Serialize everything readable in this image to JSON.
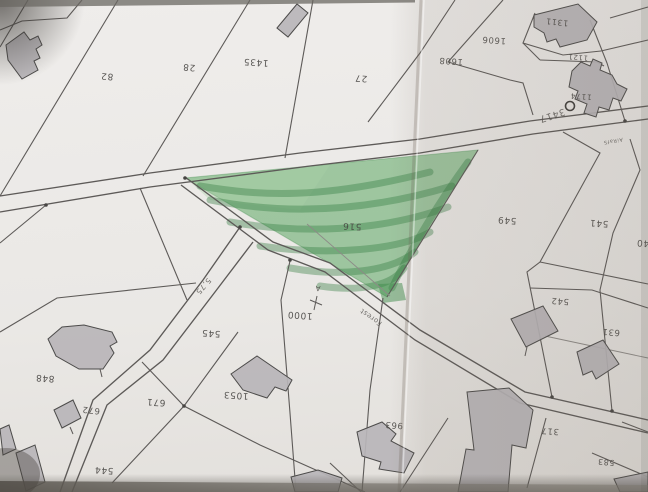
{
  "scene": {
    "description": "Photograph of a paper cadastral plan, shot upside-down; a triangular parcel is highlighted with green marker. A fold shadow runs down the right side and photo edges are dark.",
    "paper_color": "#eceae7",
    "ink_color": "#5d5a58",
    "building_color": "#b8b5b9",
    "highlight_color": "#57a45e",
    "highlighted_parcel": "516",
    "text_orientation": "all map labels appear rotated 180°"
  },
  "labels": {
    "parcels": [
      {
        "text": "82",
        "x": 107,
        "y": 76,
        "r": 184,
        "s": 9
      },
      {
        "text": "28",
        "x": 189,
        "y": 67,
        "r": 184,
        "s": 9
      },
      {
        "text": "1435",
        "x": 256,
        "y": 62,
        "r": 184,
        "s": 9
      },
      {
        "text": "27",
        "x": 361,
        "y": 78,
        "r": 184,
        "s": 9
      },
      {
        "text": "1311",
        "x": 557,
        "y": 22,
        "r": 186,
        "s": 8
      },
      {
        "text": "1608",
        "x": 451,
        "y": 61,
        "r": 184,
        "s": 8.5
      },
      {
        "text": "1606",
        "x": 494,
        "y": 40,
        "r": 184,
        "s": 8.5
      },
      {
        "text": "1121",
        "x": 578,
        "y": 57,
        "r": 184,
        "s": 7
      },
      {
        "text": "1174",
        "x": 581,
        "y": 96,
        "r": 184,
        "s": 7.5
      },
      {
        "text": "516",
        "x": 352,
        "y": 226,
        "r": 183,
        "s": 9
      },
      {
        "text": "549",
        "x": 507,
        "y": 220,
        "r": 184,
        "s": 9
      },
      {
        "text": "541",
        "x": 599,
        "y": 223,
        "r": 184,
        "s": 9
      },
      {
        "text": "540",
        "x": 646,
        "y": 243,
        "r": 184,
        "s": 9
      },
      {
        "text": "542",
        "x": 560,
        "y": 301,
        "r": 184,
        "s": 8.5
      },
      {
        "text": "631",
        "x": 611,
        "y": 332,
        "r": 184,
        "s": 8.5
      },
      {
        "text": "545",
        "x": 211,
        "y": 333,
        "r": 184,
        "s": 9
      },
      {
        "text": "848",
        "x": 45,
        "y": 378,
        "r": 184,
        "s": 9
      },
      {
        "text": "672",
        "x": 91,
        "y": 410,
        "r": 186,
        "s": 8.5
      },
      {
        "text": "671",
        "x": 156,
        "y": 402,
        "r": 184,
        "s": 9
      },
      {
        "text": "544",
        "x": 104,
        "y": 470,
        "r": 184,
        "s": 9
      },
      {
        "text": "1053",
        "x": 236,
        "y": 395,
        "r": 184,
        "s": 9
      },
      {
        "text": "1000",
        "x": 300,
        "y": 315,
        "r": 184,
        "s": 9
      },
      {
        "text": "963",
        "x": 394,
        "y": 425,
        "r": 184,
        "s": 8.5
      },
      {
        "text": "317",
        "x": 550,
        "y": 431,
        "r": 184,
        "s": 8.5
      },
      {
        "text": "583",
        "x": 606,
        "y": 462,
        "r": 184,
        "s": 8
      }
    ],
    "roads": [
      {
        "text": "3417",
        "x": 552,
        "y": 115,
        "r": 162,
        "s": 9.5
      },
      {
        "text": "5,75",
        "x": 203,
        "y": 286,
        "r": 131,
        "s": 7.5
      },
      {
        "text": "Forest",
        "x": 371,
        "y": 317,
        "r": 215,
        "s": 7
      },
      {
        "text": "AiRafS",
        "x": 613,
        "y": 141,
        "r": 170,
        "s": 5
      }
    ]
  },
  "markers": {
    "circle": {
      "x": 570,
      "y": 106,
      "r": 4.5
    },
    "a": {
      "text": "A",
      "x": 318,
      "y": 286,
      "r": 185,
      "s": 7
    },
    "dots": [
      [
        46,
        205
      ],
      [
        240,
        227
      ],
      [
        290,
        260
      ],
      [
        184,
        406
      ],
      [
        552,
        397
      ],
      [
        612,
        411
      ],
      [
        185,
        178
      ],
      [
        625,
        121
      ]
    ],
    "ticks": [
      "M310,300 L322,305",
      "M317,296 L314,310",
      "M100,369 L102,377",
      "M70,427 L73,434",
      "M527,347 L525,356"
    ]
  },
  "geometry": {
    "roads": [
      "M0,196 L150,173 L300,153 L420,139 L530,121 L648,106",
      "M0,212 L150,187 L310,166 L420,153 L533,134 L648,119",
      "M185,177 L273,242 L330,263 L420,330 L525,392 L648,420",
      "M181,185 L268,250 L325,272 L415,340 L520,403 L648,433",
      "M240,227 L203,280 L150,350 L93,400 L60,492",
      "M253,242 L215,292 L163,360 L107,405 L72,492"
    ],
    "lines": [
      "M28,0 L0,47",
      "M118,0 L0,196",
      "M82,0 L67,18 L22,21 L0,30",
      "M250,0 L143,176",
      "M313,0 L285,158",
      "M455,0 L420,53 L368,122",
      "M503,0 L448,62 L510,80 L523,83 L533,115",
      "M535,13 L523,43 L563,55 L601,51",
      "M601,51 L648,40",
      "M610,18 L648,7",
      "M523,43 L540,60",
      "M540,60 L597,62 L604,66",
      "M590,20 L607,63 L625,121",
      "M563,132 L600,153 L540,262 L527,272 L552,397",
      "M630,139 L640,170 L613,233 L600,290 L612,411",
      "M540,262 L648,284",
      "M530,288 L592,290 L648,308",
      "M478,150 L387,297",
      "M46,205 L0,243",
      "M0,332 L57,298 L196,283",
      "M140,188 L187,300",
      "M290,261 L281,300 L290,413 L296,492",
      "M383,298 L370,390 L362,492",
      "M238,332 L184,406 L112,483",
      "M142,362 L184,406 L260,445 L365,492",
      "M546,418 L527,488",
      "M592,453 L648,477",
      "M622,422 L648,432",
      "M448,418 L413,472 L400,492",
      "M330,463 L361,492"
    ],
    "faint_lines": [
      "M545,336 L648,358",
      "M307,224 L390,296"
    ],
    "buildings": [
      "M6,45 L24,32 L30,40 L38,36 L42,45 L36,49 L40,58 L34,61 L38,70 L22,79 L8,60 Z",
      "M277,28 L297,4 L308,13 L288,37 Z",
      "M534,15 L578,4 L597,22 L587,40 L560,47 L556,39 L547,42 L544,33 L534,27 Z",
      "M572,71 L581,62 L590,66 L593,59 L602,63 L600,70 L612,75 L617,84 L627,89 L621,101 L613,98 L609,110 L599,107 L596,117 L584,113 L587,104 L575,99 L578,91 L569,87 Z",
      "M48,339 L62,327 L84,325 L112,332 L117,342 L110,346 L114,353 L103,369 L79,369 L56,356 Z",
      "M54,410 L73,400 L81,418 L62,428 Z",
      "M231,374 L257,356 L292,380 L286,391 L275,387 L267,398 L243,390 Z",
      "M511,319 L543,306 L558,331 L526,347 Z",
      "M577,352 L603,340 L619,364 L596,379 L592,371 L583,375 Z",
      "M357,432 L382,422 L396,434 L391,441 L414,453 L404,473 L379,469 L381,462 L362,456 Z",
      "M467,392 L509,388 L533,410 L526,448 L512,445 L508,492 L458,492 L466,449 L474,450 Z",
      "M291,477 L318,470 L342,478 L338,492 L295,492 Z",
      "M614,479 L648,472 L648,492 L620,492 Z",
      "M16,453 L35,445 L45,482 L26,491 Z",
      "M0,429 L9,425 L16,449 L3,455 Z"
    ],
    "green": {
      "outline": "M185,178 L478,150 L387,297 Z",
      "wash": "M188,180 L330,165 L300,210 L210,200 Z",
      "streaks": [
        "M200,186 C260,196 320,200 430,172",
        "M210,200 C280,214 360,214 452,186",
        "M230,222 C300,234 380,232 448,207",
        "M260,246 C330,256 400,250 430,232",
        "M290,268 C340,277 390,272 415,252",
        "M320,286 C360,292 392,286 404,268",
        "M468,162 C440,200 410,250 392,288"
      ],
      "blob": "M378,284 L402,283 L406,300 L383,303 Z"
    }
  }
}
